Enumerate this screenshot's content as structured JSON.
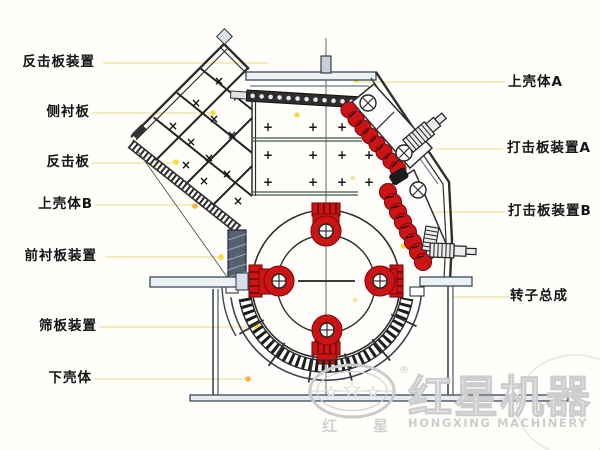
{
  "parts_left": [
    {
      "name": "反击板装置"
    },
    {
      "name": "侧衬板"
    },
    {
      "name": "反击板"
    },
    {
      "name": "上壳体B"
    },
    {
      "name": "前衬板装置"
    },
    {
      "name": "筛板装置"
    },
    {
      "name": "下壳体"
    }
  ],
  "parts_right": [
    {
      "name": "上壳体A"
    },
    {
      "name": "打击板装置A"
    },
    {
      "name": "打击板装置B"
    },
    {
      "name": "转子总成"
    }
  ],
  "marks": {
    "hopper": "×",
    "housing": "+"
  },
  "watermark": {
    "registered": "®",
    "star": "★",
    "logo_cn_left": "红",
    "logo_cn_right": "星",
    "brand_cn": "红星机器",
    "brand_en": "HONGXING MACHINERY"
  },
  "colors": {
    "part_red": "#ce1316",
    "leader_line": "#efe7a6",
    "dot_yellow": "#ffd92e",
    "dot_orange": "#ffb040",
    "line_dark": "#2e2e2e",
    "steel_blue": "#394a5a",
    "watermark_gray": "#cdcdcd"
  }
}
